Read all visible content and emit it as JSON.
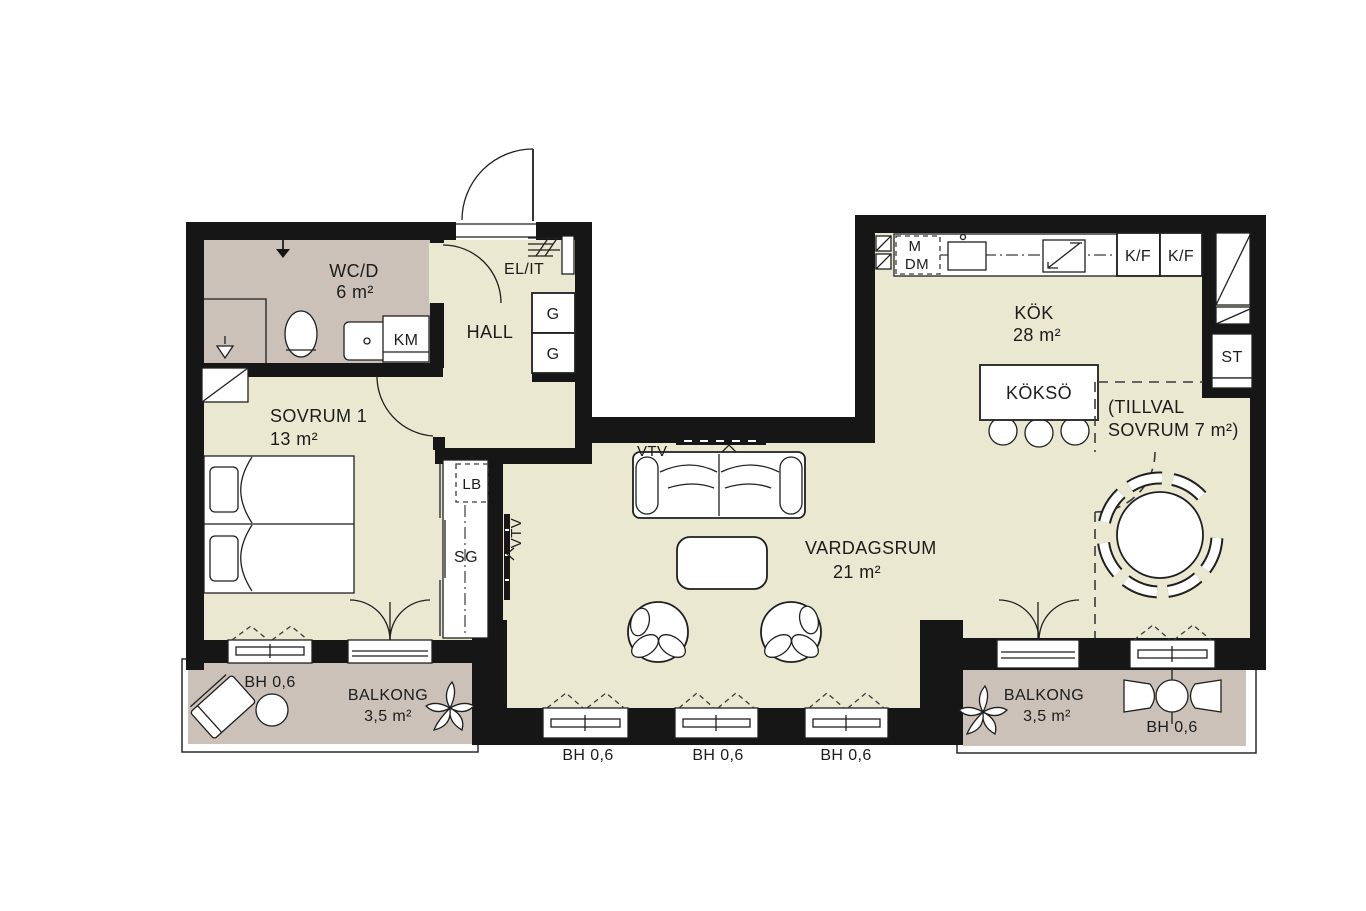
{
  "plan": {
    "rooms": {
      "wcd": {
        "name": "WC/D",
        "area": "6 m²"
      },
      "hall": {
        "name": "HALL"
      },
      "sovrum1": {
        "name": "SOVRUM 1",
        "area": "13 m²"
      },
      "vardagsrum": {
        "name": "VARDAGSRUM",
        "area": "21 m²"
      },
      "kok": {
        "name": "KÖK",
        "area": "28 m²"
      },
      "tillval": {
        "line1": "(TILLVAL",
        "line2": "SOVRUM 7 m²)"
      },
      "balkong_left": {
        "name": "BALKONG",
        "area": "3,5 m²"
      },
      "balkong_right": {
        "name": "BALKONG",
        "area": "3,5 m²"
      }
    },
    "fixtures": {
      "km": "KM",
      "elit": "EL/IT",
      "g_upper": "G",
      "g_lower": "G",
      "lb": "LB",
      "sg": "SG",
      "vtv_sofa": "VTV",
      "vtv_side": "VTV",
      "m": "M",
      "dm": "DM",
      "kf_left": "K/F",
      "kf_right": "K/F",
      "st": "ST",
      "kokso": "KÖKSÖ"
    },
    "bh_labels": [
      "BH 0,6",
      "BH 0,6",
      "BH 0,6",
      "BH 0,6",
      "BH 0,6"
    ],
    "colors": {
      "floor": "#eae8d0",
      "wet_room": "#cbc1b8",
      "balcony": "#cbc1b8",
      "wall": "#161616",
      "line": "#1f1f1f"
    }
  }
}
